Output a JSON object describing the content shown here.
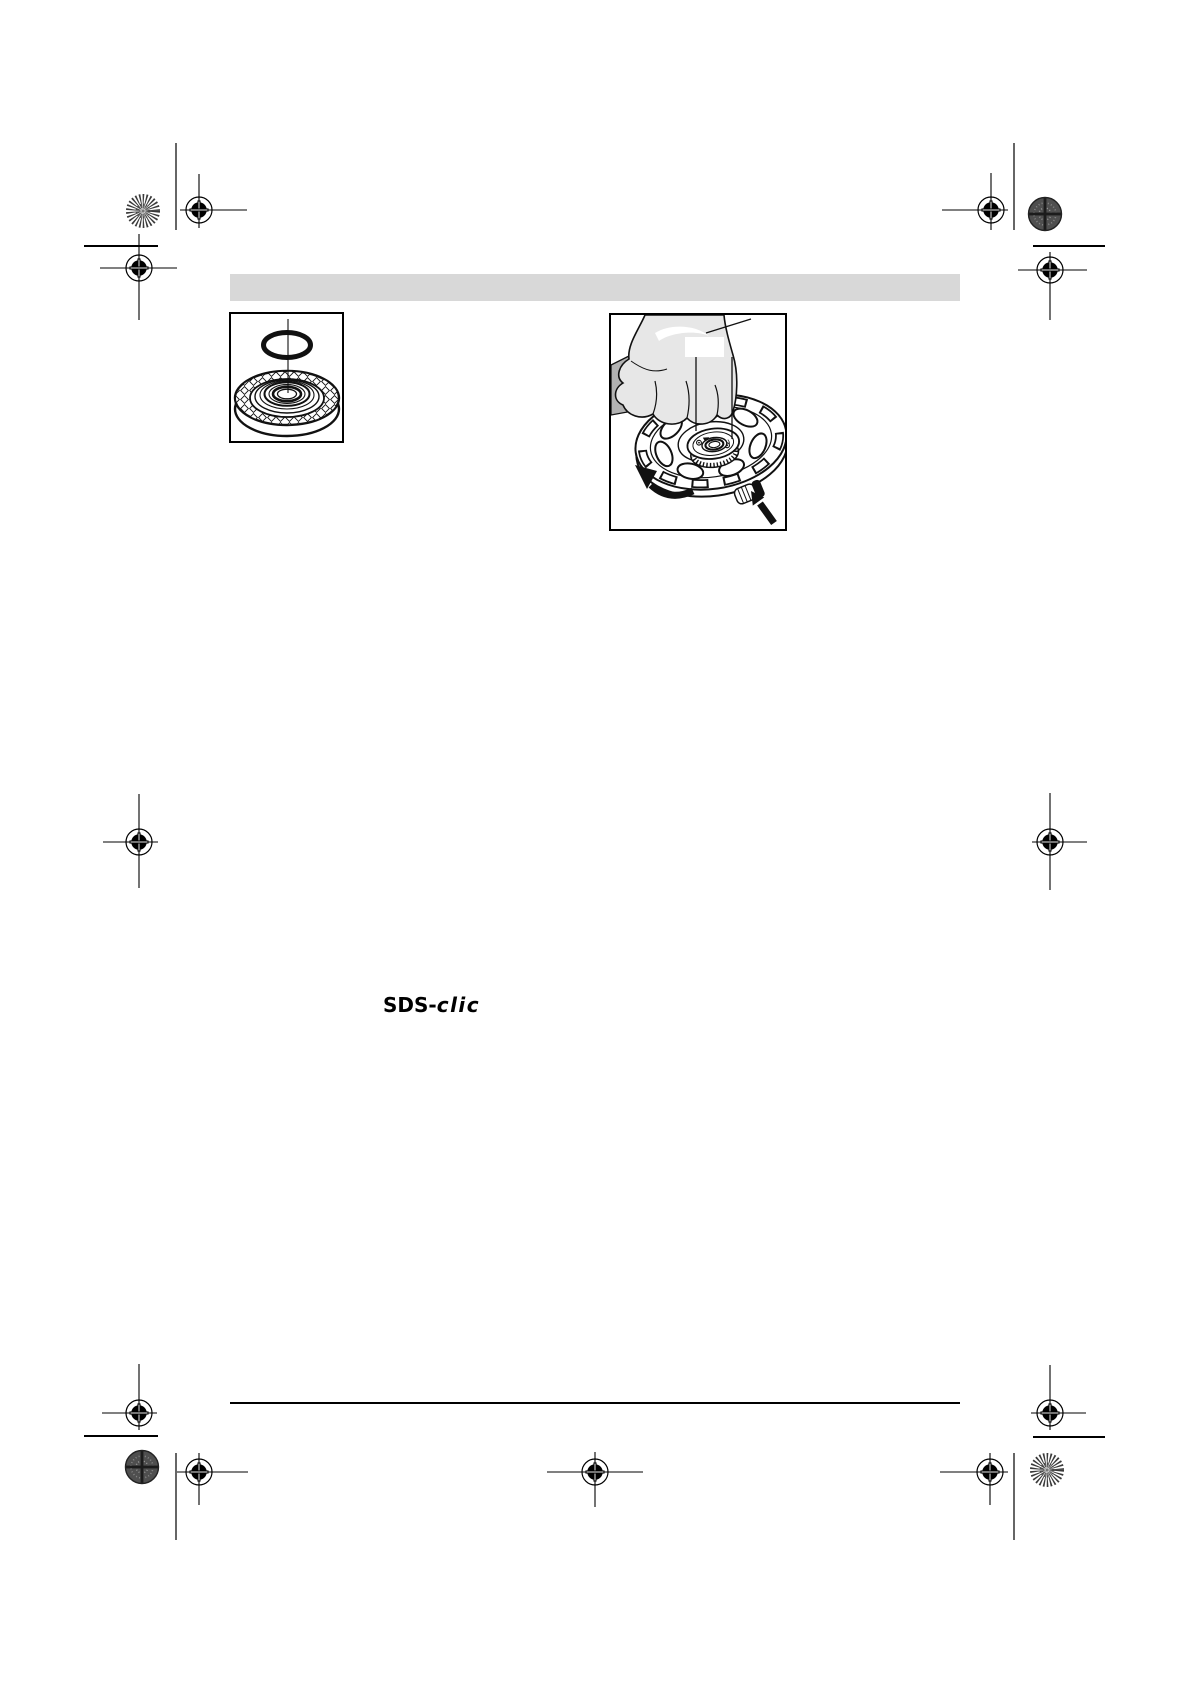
{
  "page": {
    "width": 1190,
    "height": 1684,
    "background": "#ffffff"
  },
  "header_bar": {
    "color": "#d8d8d8"
  },
  "logo": {
    "text": "SDS-clic",
    "prefix": "SDS-",
    "suffix": "clic"
  },
  "colors": {
    "ink": "#000000",
    "line_art": "#111111",
    "glove_light": "#e7e7e7",
    "glove_shadow": "#b2b2b2",
    "halftone_patch": "#4f4f4f",
    "footer_rule": "#000000"
  }
}
